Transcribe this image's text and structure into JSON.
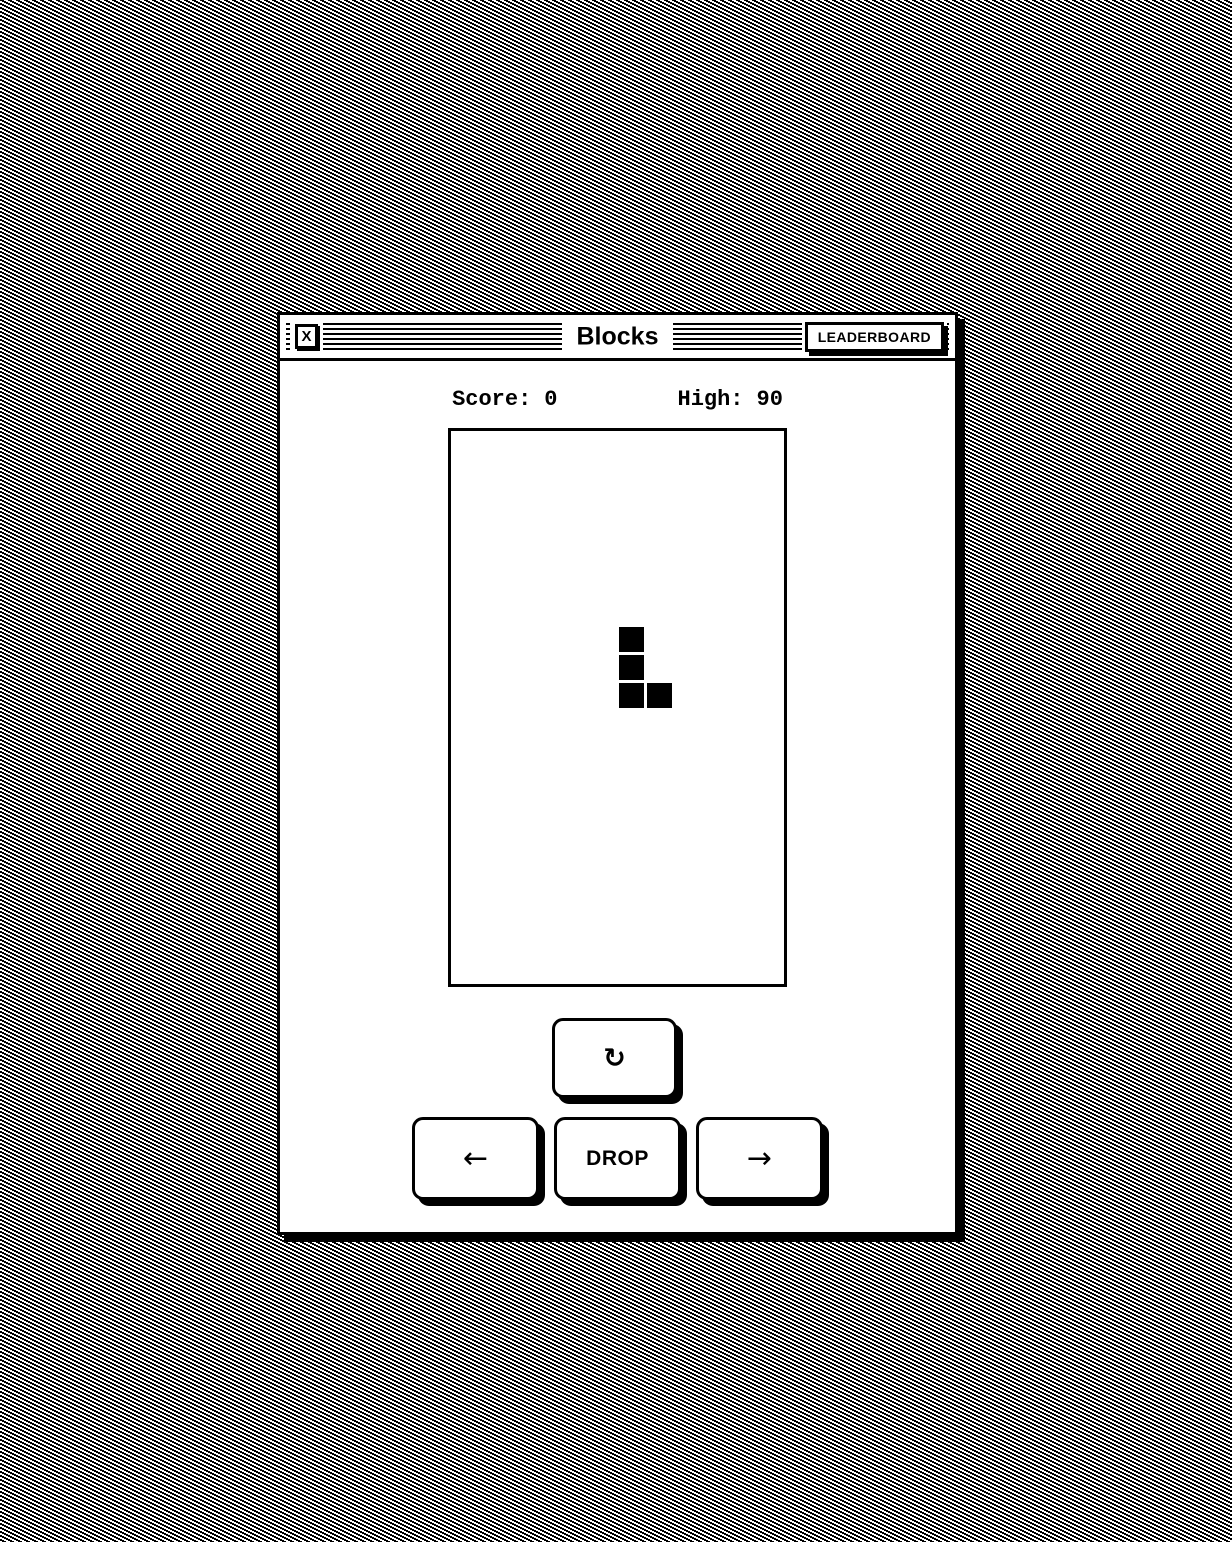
{
  "window": {
    "title": "Blocks",
    "close_button": "X",
    "leaderboard_button": "LEADERBOARD"
  },
  "scoreboard": {
    "score_label": "Score:",
    "score_value": "0",
    "high_label": "High:",
    "high_value": "90"
  },
  "controls": {
    "rotate_icon": "↻",
    "left_icon": "←",
    "drop_label": "DROP",
    "right_icon": "→"
  },
  "game": {
    "piece_type": "J",
    "grid_px": 28,
    "block_px": 25,
    "piece_cells": [
      {
        "col": 6,
        "row": 7
      },
      {
        "col": 6,
        "row": 8
      },
      {
        "col": 6,
        "row": 9
      },
      {
        "col": 7,
        "row": 9
      }
    ]
  },
  "colors": {
    "foreground": "#000000",
    "background": "#ffffff"
  }
}
